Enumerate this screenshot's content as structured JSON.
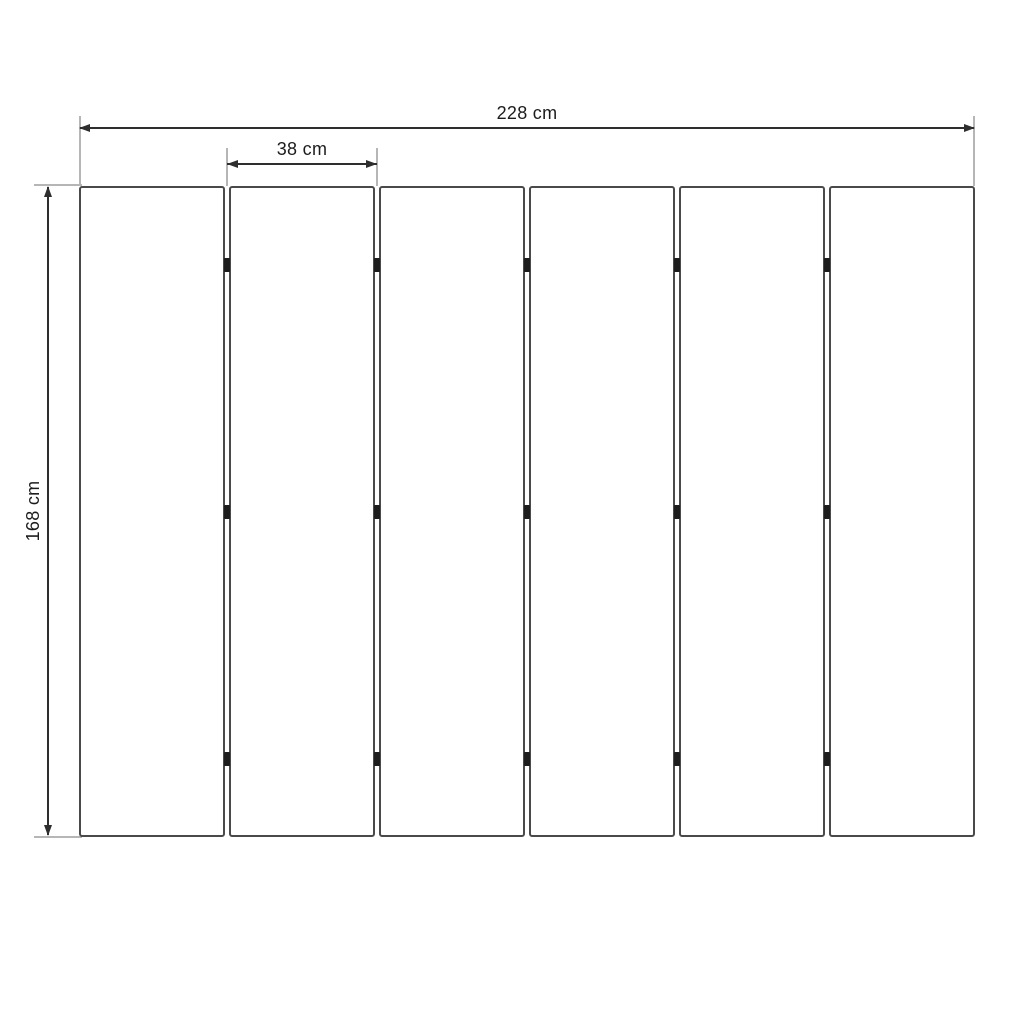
{
  "drawing": {
    "type": "panel-dimension-diagram",
    "panel_count": 6,
    "joint_count": 5,
    "hinges_per_joint": 3,
    "dimensions": {
      "total_width": {
        "value": 228,
        "unit": "cm",
        "label": "228 cm"
      },
      "panel_width": {
        "value": 38,
        "unit": "cm",
        "label": "38 cm"
      },
      "height": {
        "value": 168,
        "unit": "cm",
        "label": "168 cm"
      }
    },
    "colors": {
      "background": "#ffffff",
      "panel_border": "#4a4a4a",
      "dimension_line": "#2e2e2e",
      "extension_line": "#b6b6b6",
      "hinge": "#1d1d1d",
      "text": "#1c1c1c"
    }
  }
}
